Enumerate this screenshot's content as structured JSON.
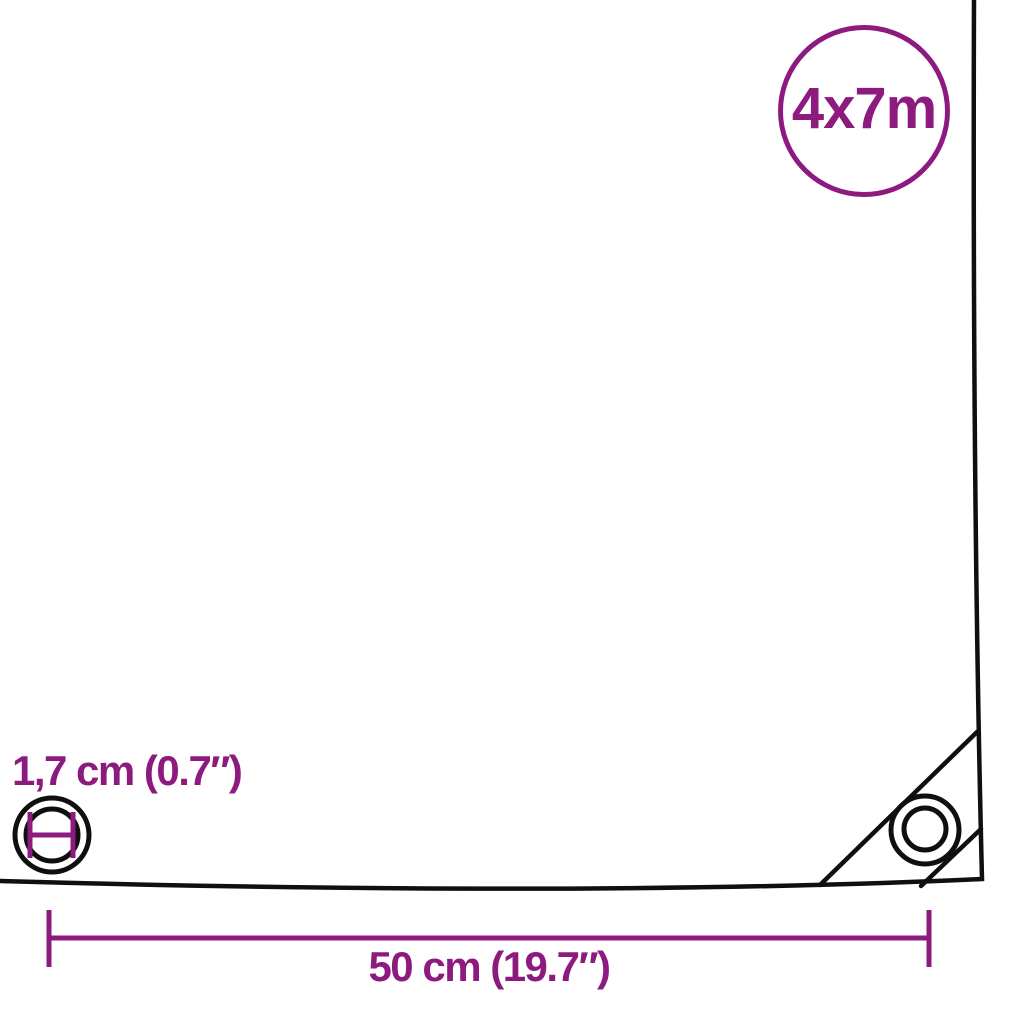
{
  "size_badge": {
    "label": "4x7m"
  },
  "labels": {
    "grommet_diameter": "1,7 cm (0.7″)",
    "grommet_spacing": "50 cm (19.7″)"
  },
  "colors": {
    "accent": "#8d1a7e",
    "line": "#0f0f0f",
    "background": "#ffffff"
  },
  "icons": {
    "grommet_diameter_icon": "eyelet ring with horizontal diameter measure mark",
    "corner_grommet_icon": "corner eyelet ring on reinforced fold",
    "measure_line_icon": "horizontal dimension line with end ticks"
  }
}
